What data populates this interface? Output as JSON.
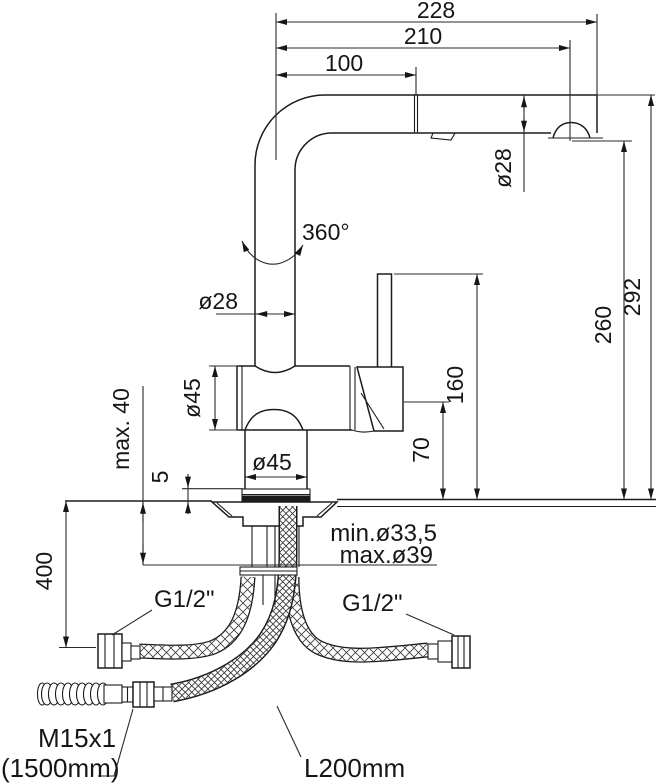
{
  "drawing": {
    "type": "faucet-installation-dimension-drawing",
    "line_color": "#1c1c1c",
    "background": "#ffffff",
    "dimensions": {
      "reach_overall": "228",
      "reach_to_outlet": "210",
      "reach_to_joint": "100",
      "spout_tube_dia": "ø28",
      "swivel_angle": "360°",
      "column_dia": "ø28",
      "body_dia": "ø45",
      "base_dia": "ø45",
      "height_overall": "292",
      "height_outlet": "260",
      "height_lever_top": "160",
      "height_handle_base": "70",
      "deck_thickness_max": "max. 40",
      "base_plate_height": "5",
      "hole_dia_min": "min.ø33,5",
      "hole_dia_max": "max.ø39",
      "hose_drop_length": "400",
      "left_supply_thread": "G1/2\"",
      "right_supply_thread": "G1/2\"",
      "spray_hose_thread": "M15x1",
      "spray_hose_length": "(1500mm)",
      "supply_hose_length": "L200mm"
    }
  }
}
